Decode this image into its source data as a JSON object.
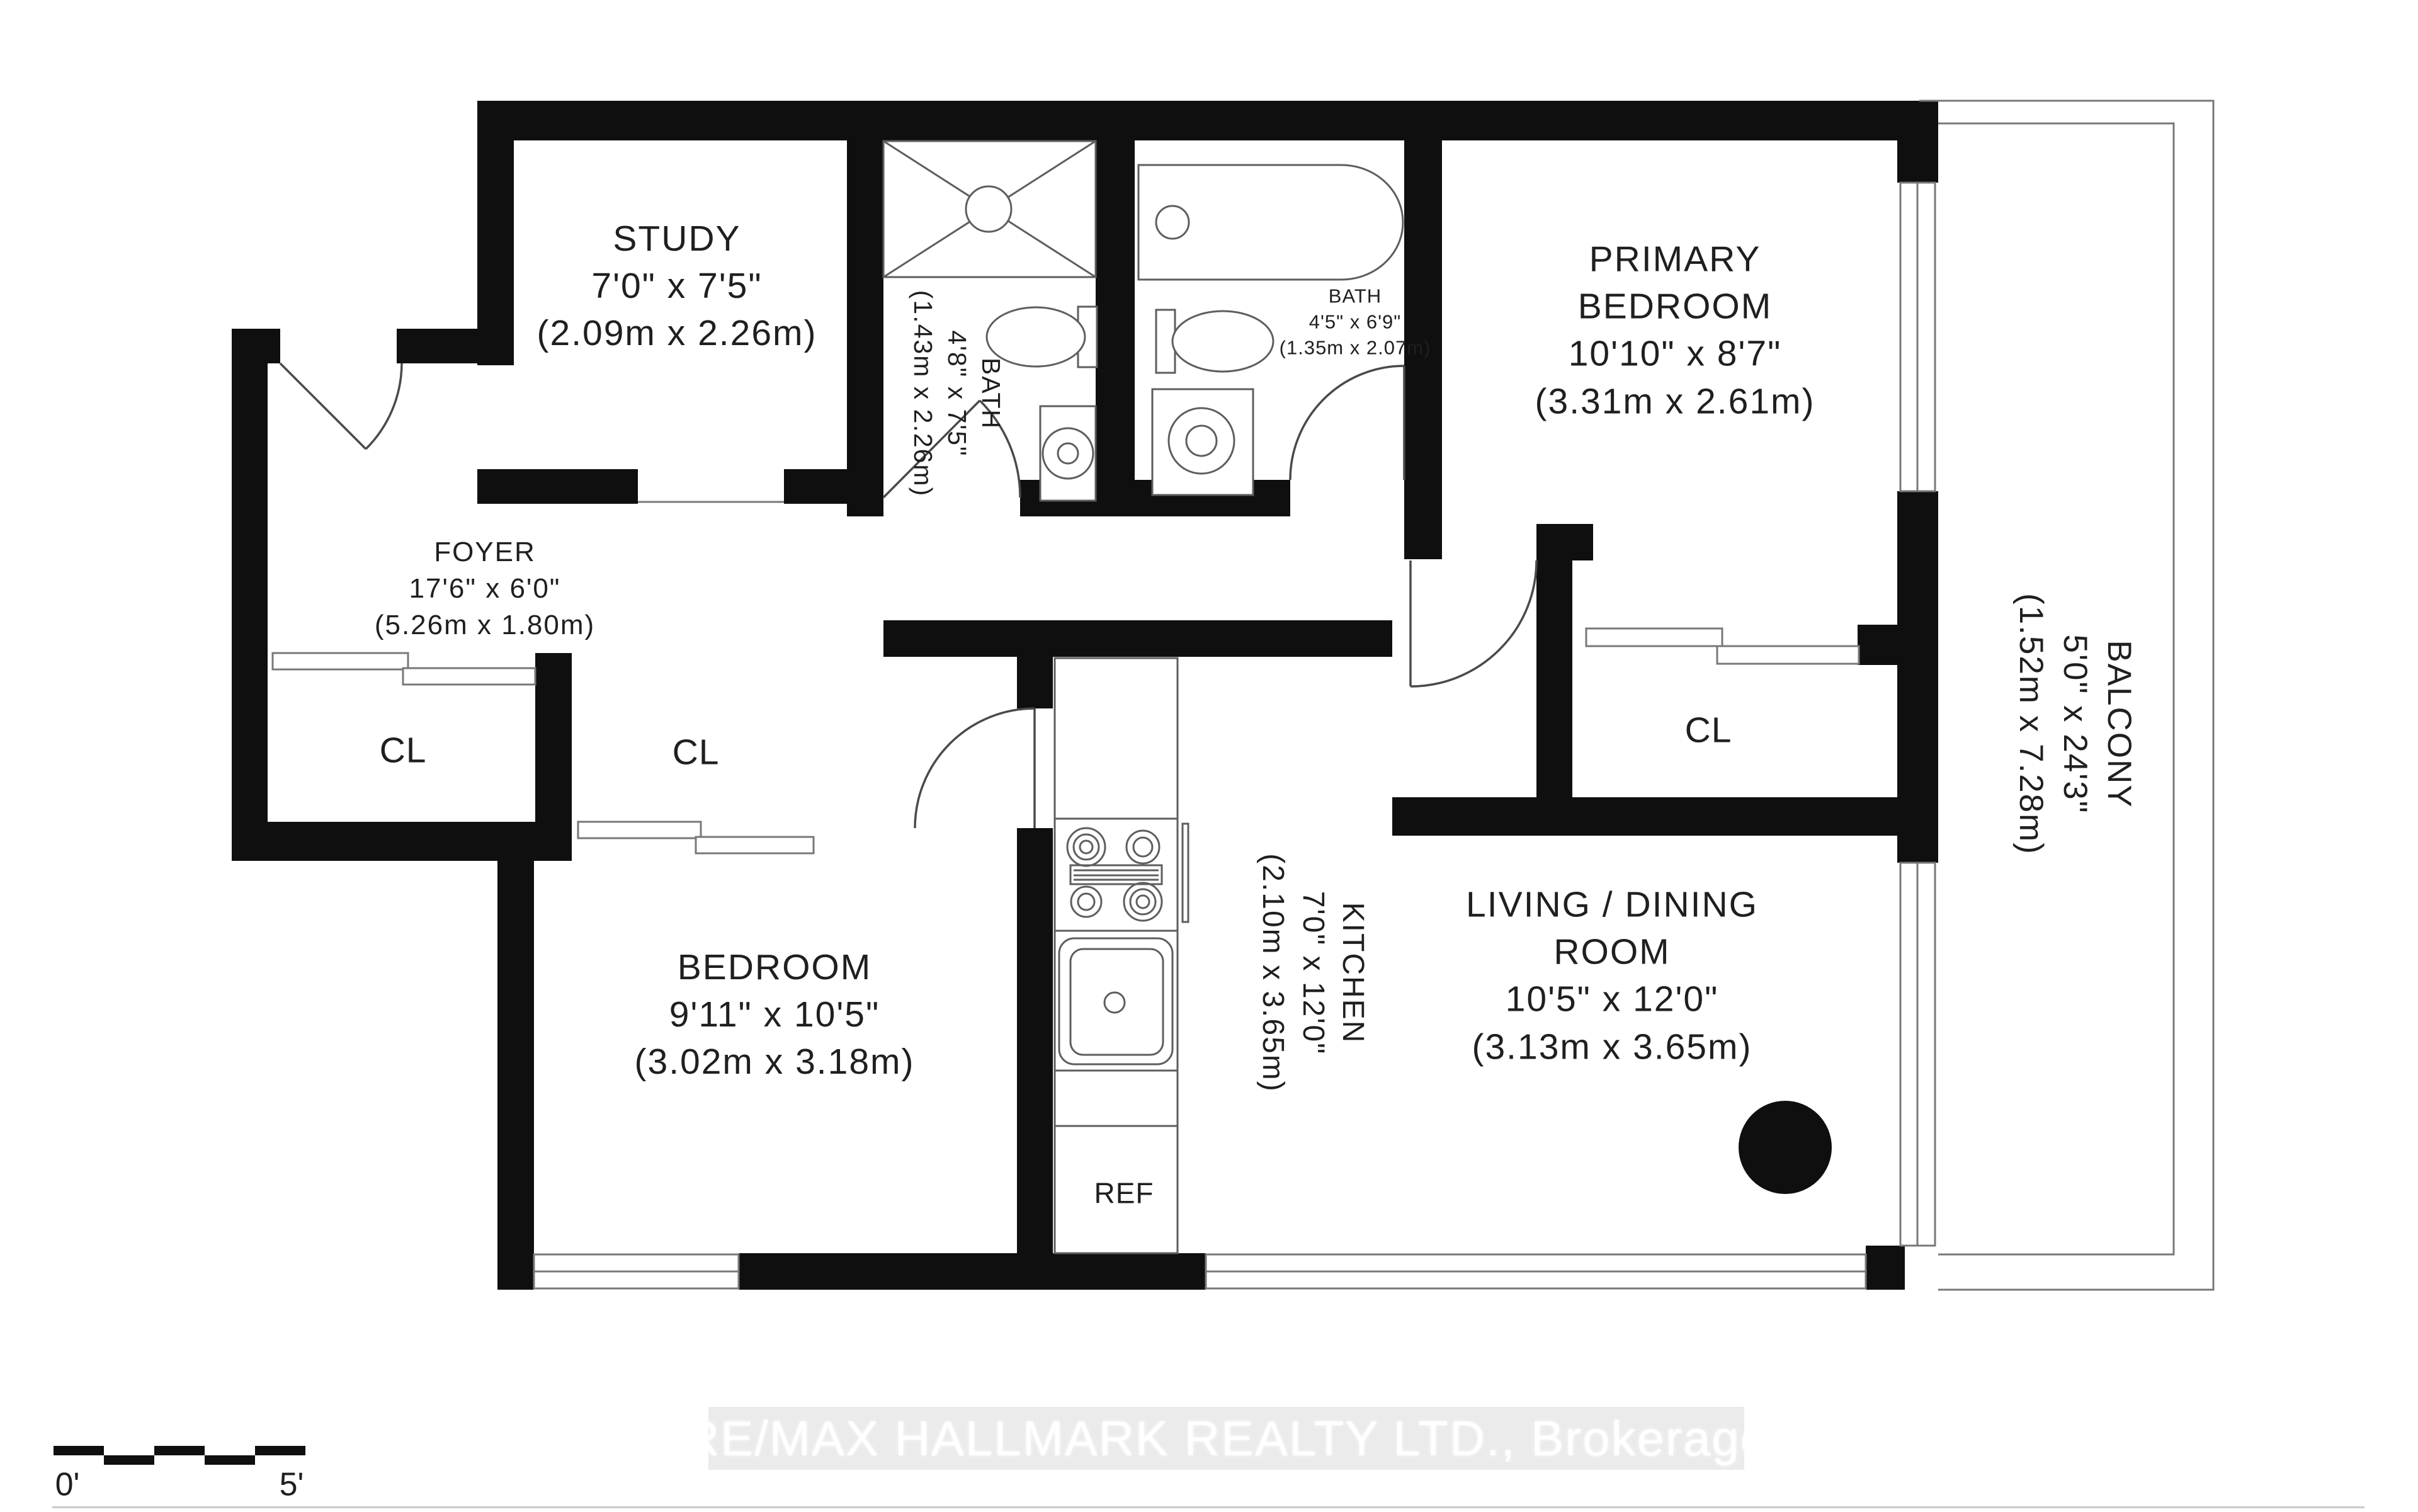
{
  "plan": {
    "rooms": {
      "study": {
        "lines": [
          "STUDY",
          "7'0\" x 7'5\"",
          "(2.09m x 2.26m)"
        ]
      },
      "foyer": {
        "lines": [
          "FOYER",
          "17'6\" x 6'0\"",
          "(5.26m x 1.80m)"
        ]
      },
      "bath1": {
        "lines": [
          "BATH",
          "4'8\" x 7'5\"",
          "(1.43m x 2.26m)"
        ]
      },
      "bath2": {
        "lines": [
          "BATH",
          "4'5\" x 6'9\"",
          "(1.35m x 2.07m)"
        ]
      },
      "primary": {
        "lines": [
          "PRIMARY",
          "BEDROOM",
          "10'10\" x 8'7\"",
          "(3.31m x 2.61m)"
        ]
      },
      "bedroom": {
        "lines": [
          "BEDROOM",
          "9'11\" x 10'5\"",
          "(3.02m x 3.18m)"
        ]
      },
      "kitchen": {
        "lines": [
          "KITCHEN",
          "7'0\" x 12'0\"",
          "(2.10m x 3.65m)"
        ]
      },
      "living": {
        "lines": [
          "LIVING / DINING",
          "ROOM",
          "10'5\" x 12'0\"",
          "(3.13m x 3.65m)"
        ]
      },
      "balcony": {
        "lines": [
          "BALCONY",
          "5'0\" x 24'3\"",
          "(1.52m x 7.28m)"
        ]
      }
    },
    "closets": {
      "cl1": "CL",
      "cl2": "CL",
      "cl3": "CL"
    },
    "appliances": {
      "fridge": "REF"
    },
    "scale_bar": {
      "start": "0'",
      "end": "5'"
    },
    "watermark": "RE/MAX HALLMARK REALTY LTD., Brokerage",
    "colors": {
      "wall": "#0f0f0f",
      "thin_line": "#787878",
      "fixture_line": "#5e5e5e",
      "text": "#1f1f1f",
      "watermark_bg": "#ebebeb",
      "watermark_text": "#ffffff"
    }
  }
}
